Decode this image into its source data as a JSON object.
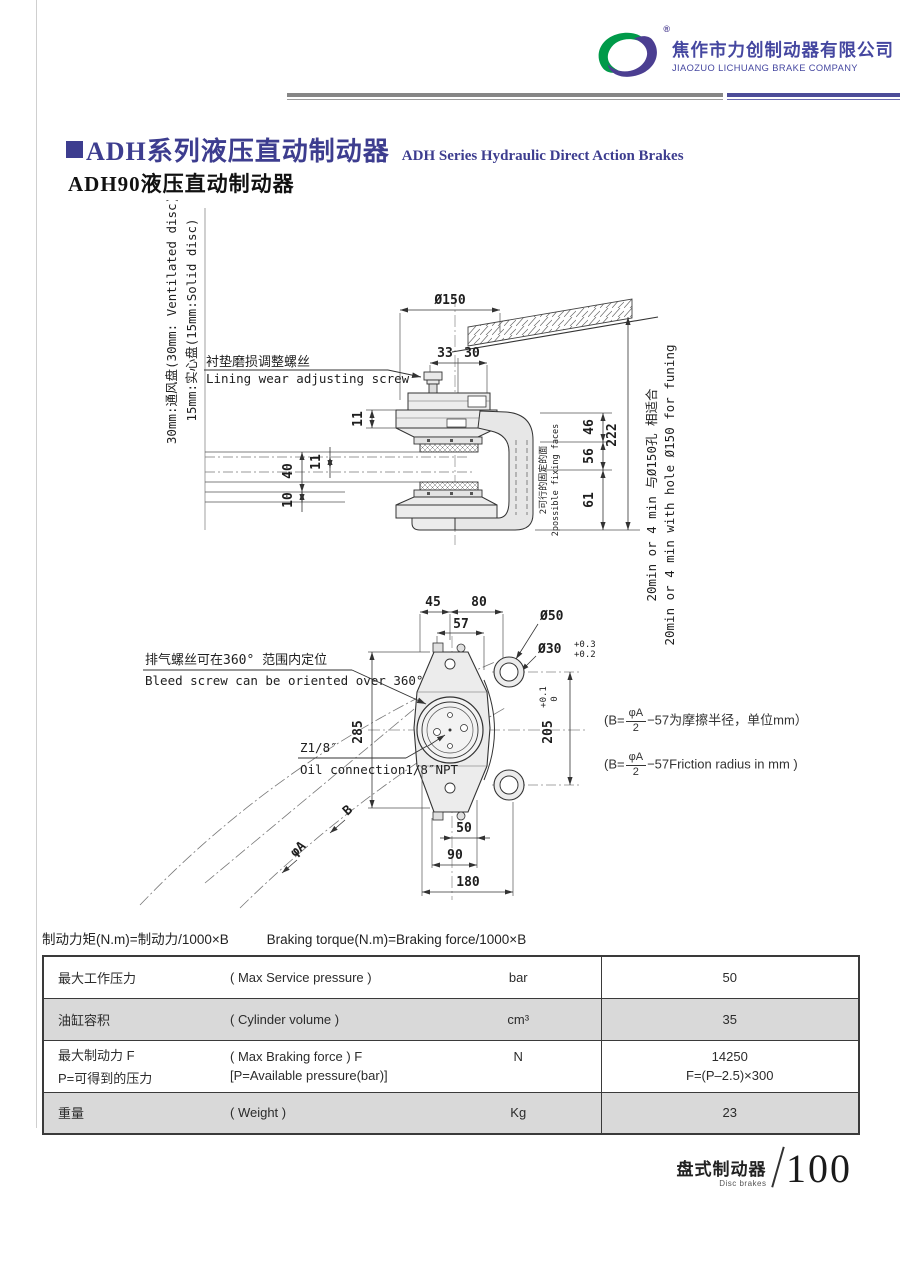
{
  "colors": {
    "accent": "#3d3d8f",
    "logo_green": "#009a49",
    "logo_purple": "#4b3e91",
    "table_gray": "#d9d9d9"
  },
  "header": {
    "company_zh": "焦作市力创制动器有限公司",
    "company_en": "JIAOZUO LICHUANG BRAKE COMPANY",
    "registered": "®"
  },
  "title": {
    "series_zh": "ADH系列液压直动制动器",
    "series_en": "ADH Series Hydraulic Direct Action Brakes",
    "model": "ADH90液压直动制动器"
  },
  "drawing": {
    "disc_note_line1": "30mm:通风盘(30mm: Ventilated disc)",
    "disc_note_line2": "15mm:实心盘(15mm:Solid disc)",
    "adjust_zh": "衬垫磨损调整螺丝",
    "adjust_en": "Lining wear adjusting screw",
    "fixing_zh": "2可行的固定的面",
    "fixing_en": "2possible fixing faces",
    "fit_zh": "20min or 4 min 与Ø150孔 相适合",
    "fit_en": "20min or 4 min with hole Ø150 for funing",
    "bleed_zh": "排气螺丝可在360° 范围内定位",
    "bleed_en": "Bleed screw can be oriented over 360°",
    "oil_zh": "Z1/8″",
    "oil_en": "Oil connection1/8″NPT",
    "friction_prefix": "(B=",
    "frac_num": "φA",
    "frac_den": "2",
    "friction_zh": "−57为摩擦半径，单位mm）",
    "friction_en": "−57Friction radius in mm )",
    "dims": {
      "dia150": "Ø150",
      "d33": "33",
      "d30": "30",
      "d11": "11",
      "d40": "40",
      "d10": "10",
      "d46": "46",
      "d56": "56",
      "d61": "61",
      "d222": "222",
      "d45": "45",
      "d80": "80",
      "d57": "57",
      "dia50": "Ø50",
      "dia30": "Ø30",
      "dia30_tol_up": "+0.3",
      "dia30_tol_dn": "+0.2",
      "d205": "205",
      "d205_tol_up": "+0.1",
      "d205_tol_dn": "0",
      "d285": "285",
      "d50": "50",
      "d90": "90",
      "d180": "180",
      "phiA": "φA",
      "b": "B"
    }
  },
  "formula": {
    "zh": "制动力矩(N.m)=制动力/1000×B",
    "en": "Braking torque(N.m)=Braking force/1000×B"
  },
  "table": {
    "rows": [
      {
        "zh": "最大工作压力",
        "en": "( Max Service pressure )",
        "unit": "bar",
        "value": "50"
      },
      {
        "zh": "油缸容积",
        "en": "( Cylinder volume )",
        "unit": "cm³",
        "value": "35"
      },
      {
        "zh": "最大制动力  F",
        "zh2": "P=可得到的压力",
        "en": "( Max Braking force ) F",
        "en2": "[P=Available pressure(bar)]",
        "unit": "N",
        "value": "14250",
        "value2": "F=(P–2.5)×300"
      },
      {
        "zh": "重量",
        "en": "( Weight )",
        "unit": "Kg",
        "value": "23"
      }
    ]
  },
  "footer": {
    "zh": "盘式制动器",
    "en": "Disc brakes",
    "page": "100"
  }
}
